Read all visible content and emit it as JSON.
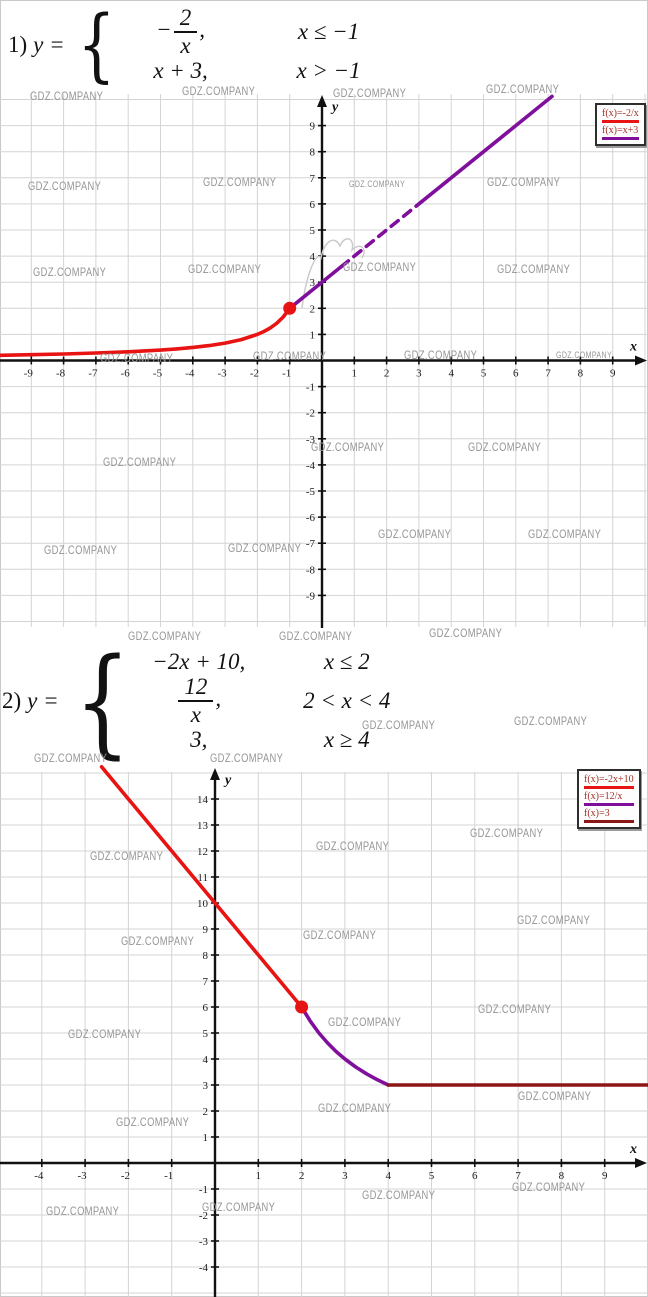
{
  "watermark_text": "GDZ.COMPANY",
  "watermarks": [
    [
      30,
      89,
      12
    ],
    [
      182,
      84,
      12
    ],
    [
      333,
      86,
      12
    ],
    [
      486,
      82,
      12
    ],
    [
      28,
      179,
      12
    ],
    [
      203,
      175,
      12
    ],
    [
      349,
      179,
      9
    ],
    [
      487,
      175,
      12
    ],
    [
      33,
      265,
      12
    ],
    [
      188,
      262,
      12
    ],
    [
      343,
      260,
      12
    ],
    [
      497,
      262,
      12
    ],
    [
      100,
      351,
      12
    ],
    [
      253,
      349,
      12
    ],
    [
      404,
      348,
      12
    ],
    [
      556,
      350,
      9
    ],
    [
      103,
      455,
      12
    ],
    [
      311,
      440,
      12
    ],
    [
      468,
      440,
      12
    ],
    [
      44,
      543,
      12
    ],
    [
      228,
      541,
      12
    ],
    [
      378,
      527,
      12
    ],
    [
      528,
      527,
      12
    ],
    [
      128,
      629,
      12
    ],
    [
      279,
      629,
      12
    ],
    [
      429,
      626,
      12
    ],
    [
      362,
      718,
      12
    ],
    [
      514,
      714,
      12
    ],
    [
      34,
      751,
      12
    ],
    [
      210,
      751,
      12
    ],
    [
      470,
      826,
      12
    ],
    [
      90,
      849,
      12
    ],
    [
      316,
      839,
      12
    ],
    [
      517,
      913,
      12
    ],
    [
      121,
      934,
      12
    ],
    [
      303,
      928,
      12
    ],
    [
      478,
      1002,
      12
    ],
    [
      68,
      1027,
      12
    ],
    [
      328,
      1015,
      12
    ],
    [
      518,
      1089,
      12
    ],
    [
      318,
      1101,
      12
    ],
    [
      116,
      1115,
      12
    ],
    [
      512,
      1180,
      12
    ],
    [
      362,
      1188,
      12
    ],
    [
      202,
      1200,
      12
    ],
    [
      46,
      1204,
      12
    ]
  ],
  "colors": {
    "red": "#e81313",
    "purple": "#80109b",
    "maroon": "#8b1717",
    "grid": "#d4d4d4",
    "axis": "#111111",
    "tick": "#1c1c1c",
    "scribble": "#c9c9c9"
  },
  "problems": [
    {
      "index": "1)",
      "lhs": "y =",
      "brace_size": 80,
      "rows": [
        {
          "prefix": "−",
          "num": "2",
          "den": "x",
          "suffix": ",",
          "cond": "x ≤ −1"
        },
        {
          "expr": "x + 3,",
          "cond": "x > −1"
        }
      ]
    },
    {
      "index": "2)",
      "lhs": "y =",
      "brace_size": 118,
      "rows": [
        {
          "expr": "−2x + 10,",
          "cond": "x ≤ 2"
        },
        {
          "num": "12",
          "den": "x",
          "suffix": ",",
          "cond": "2 < x < 4"
        },
        {
          "expr": "3,",
          "cond": "x ≥ 4"
        }
      ]
    }
  ],
  "chart_data": [
    {
      "type": "line",
      "title": "y = -2/x for x ≤ -1 ; y = x + 3 for x > -1",
      "xlabel": "x",
      "ylabel": "y",
      "xlim": [
        -10,
        10
      ],
      "ylim": [
        -10,
        10
      ],
      "grid": true,
      "legend_position": "top-right",
      "x_ticks": [
        -9,
        -8,
        -7,
        -6,
        -5,
        -4,
        -3,
        -2,
        -1,
        1,
        2,
        3,
        4,
        5,
        6,
        7,
        8,
        9
      ],
      "y_ticks": [
        -9,
        -8,
        -7,
        -6,
        -5,
        -4,
        -3,
        -2,
        -1,
        1,
        2,
        3,
        4,
        5,
        6,
        7,
        8,
        9
      ],
      "pixel": {
        "top": 88,
        "height": 540,
        "origin": [
          322,
          360.5
        ],
        "unit": [
          32.3,
          26.1
        ],
        "grid_top": 94,
        "grid_bottom": 627,
        "x_axis_end": 647,
        "y_axis_top": 95,
        "tick_font": 11
      },
      "legend": {
        "x": 595,
        "y": 103,
        "entries": [
          {
            "label": "f(x)=-2/x",
            "color_key": "red"
          },
          {
            "label": "f(x)=x+3",
            "color_key": "purple"
          }
        ]
      },
      "series": [
        {
          "name": "f(x)=-2/x",
          "color_key": "red",
          "width": 3.6,
          "points": [
            [
              -10,
              0.2
            ],
            [
              -9,
              0.222
            ],
            [
              -8,
              0.25
            ],
            [
              -7,
              0.286
            ],
            [
              -6,
              0.333
            ],
            [
              -5,
              0.4
            ],
            [
              -4.5,
              0.444
            ],
            [
              -4,
              0.5
            ],
            [
              -3.5,
              0.571
            ],
            [
              -3,
              0.667
            ],
            [
              -2.5,
              0.8
            ],
            [
              -2,
              1
            ],
            [
              -1.8,
              1.111
            ],
            [
              -1.6,
              1.25
            ],
            [
              -1.4,
              1.429
            ],
            [
              -1.2,
              1.667
            ],
            [
              -1,
              2
            ]
          ]
        },
        {
          "name": "f(x)=x+3",
          "color_key": "purple",
          "width": 3.6,
          "points": [
            [
              -1,
              2
            ],
            [
              0.6,
              3.6
            ]
          ]
        },
        {
          "name": "f(x)=x+3",
          "color_key": "purple",
          "width": 3.6,
          "dash": "9 7",
          "points": [
            [
              0.6,
              3.6
            ],
            [
              3.1,
              6.1
            ]
          ]
        },
        {
          "name": "f(x)=x+3",
          "color_key": "purple",
          "width": 3.6,
          "points": [
            [
              3.1,
              6.1
            ],
            [
              7.12,
              10.12
            ]
          ]
        }
      ],
      "dots": [
        {
          "x": -1,
          "y": 2,
          "r": 6.5,
          "color_key": "red"
        }
      ],
      "scribble": "M 302 308 C 306 276 316 250 321 258 C 324 242 334 234 340 246 C 345 234 355 238 352 250 C 360 242 368 248 362 258"
    },
    {
      "type": "line",
      "title": "y = -2x+10 for x ≤ 2 ; y = 12/x for 2 < x < 4 ; y = 3 for x ≥ 4",
      "xlabel": "x",
      "ylabel": "y",
      "xlim": [
        -5,
        10
      ],
      "ylim": [
        -5,
        15
      ],
      "grid": true,
      "legend_position": "top-right",
      "x_ticks": [
        -4,
        -3,
        -2,
        -1,
        1,
        2,
        3,
        4,
        5,
        6,
        7,
        8,
        9
      ],
      "y_ticks": [
        -4,
        -3,
        -2,
        -1,
        1,
        2,
        3,
        4,
        5,
        6,
        7,
        8,
        9,
        10,
        11,
        12,
        13,
        14
      ],
      "pixel": {
        "top": 763,
        "height": 534,
        "origin": [
          215,
          1163
        ],
        "unit": [
          43.3,
          26.0
        ],
        "grid_top": 772,
        "grid_bottom": 1297,
        "x_axis_end": 647,
        "y_axis_top": 768,
        "tick_font": 11
      },
      "legend": {
        "x": 577,
        "y": 769,
        "entries": [
          {
            "label": "f(x)=-2x+10",
            "color_key": "red"
          },
          {
            "label": "f(x)=12/x",
            "color_key": "purple"
          },
          {
            "label": "f(x)=3",
            "color_key": "maroon"
          }
        ]
      },
      "series": [
        {
          "name": "f(x)=-2x+10",
          "color_key": "red",
          "width": 3.6,
          "points": [
            [
              -2.62,
              15.24
            ],
            [
              2,
              6
            ]
          ]
        },
        {
          "name": "f(x)=12/x",
          "color_key": "purple",
          "width": 3.6,
          "points": [
            [
              2,
              6
            ],
            [
              2.2,
              5.455
            ],
            [
              2.4,
              5
            ],
            [
              2.6,
              4.615
            ],
            [
              2.8,
              4.286
            ],
            [
              3,
              4
            ],
            [
              3.25,
              3.692
            ],
            [
              3.5,
              3.429
            ],
            [
              3.75,
              3.2
            ],
            [
              4,
              3
            ]
          ]
        },
        {
          "name": "f(x)=3",
          "color_key": "maroon",
          "width": 3.6,
          "points": [
            [
              4,
              3
            ],
            [
              10,
              3
            ]
          ]
        }
      ],
      "dots": [
        {
          "x": 2,
          "y": 6,
          "r": 6.5,
          "color_key": "red"
        }
      ]
    }
  ]
}
